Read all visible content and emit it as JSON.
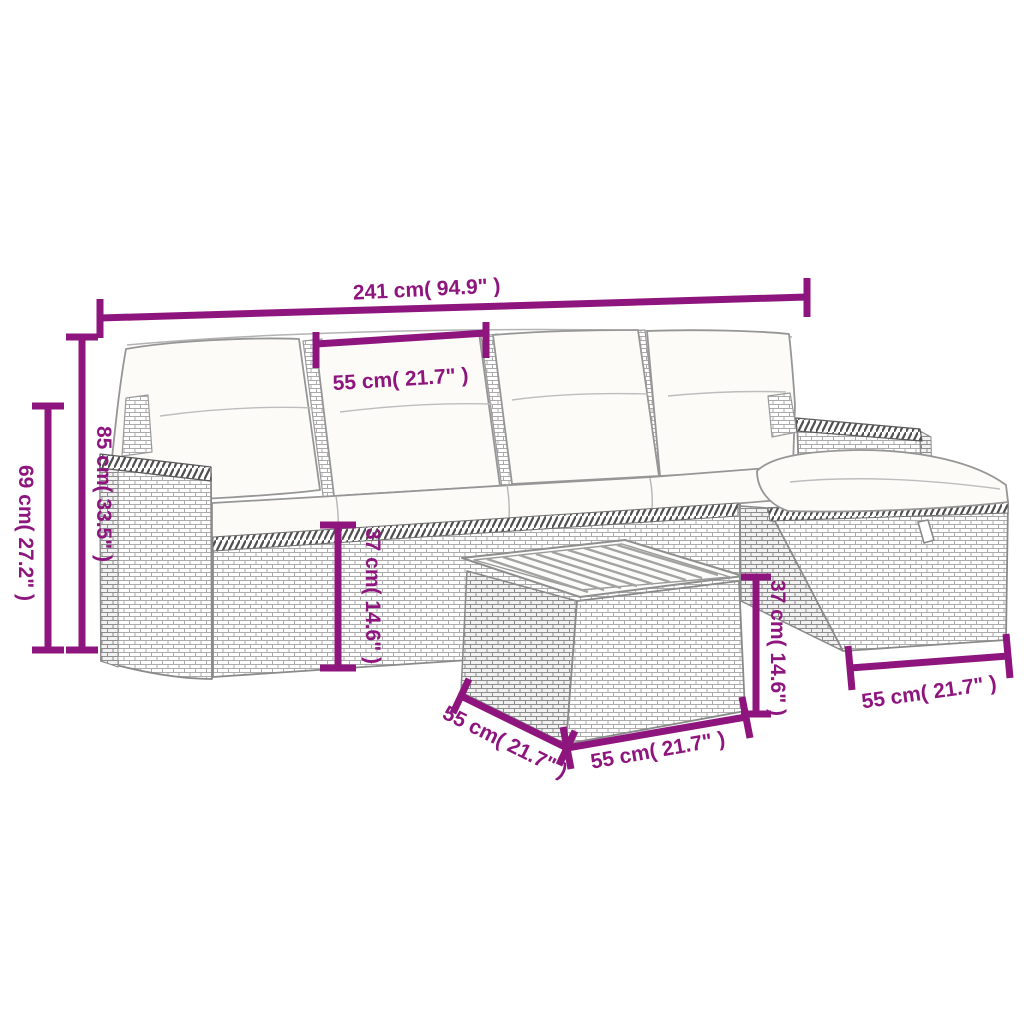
{
  "diagram": {
    "accent_color": "#8E157E",
    "line_art_color": "#8f8f8f",
    "cushion_color": "#fcfbf8",
    "background_color": "#ffffff",
    "dimensions": {
      "total_width": "241 cm( 94.9\" )",
      "seat_width": "55 cm( 21.7\" )",
      "arm_height": "69 cm( 27.2\" )",
      "back_height": "85 cm( 33.5\" )",
      "seat_height": "37 cm( 14.6\" )",
      "table_height": "37 cm( 14.6\" )",
      "table_depth": "55 cm( 21.7\" )",
      "table_width": "55 cm( 21.7\" )",
      "ottoman_width": "55 cm( 21.7\" )"
    }
  }
}
